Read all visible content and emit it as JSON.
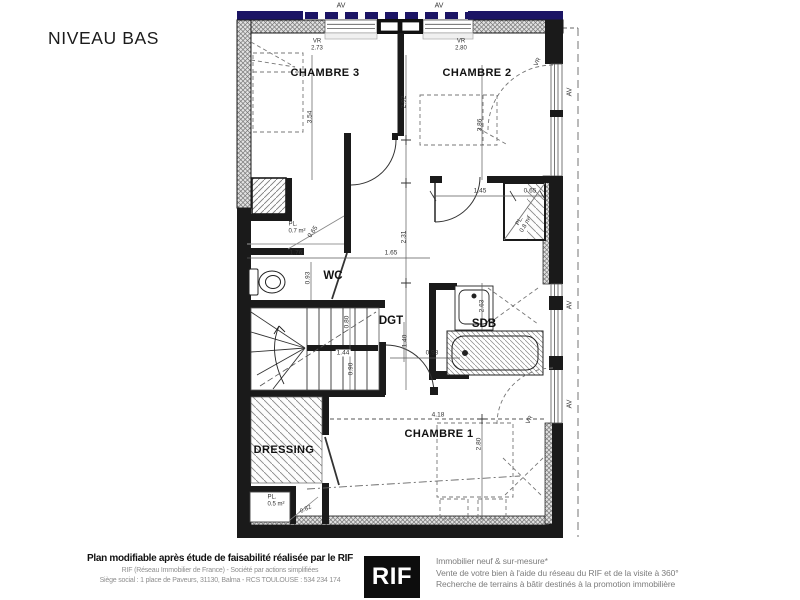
{
  "title": "NIVEAU BAS",
  "colors": {
    "wall": "#1a1a1a",
    "awning_navy": "#1b1464",
    "hatch_gray": "#8a8a8a"
  },
  "plan": {
    "rooms": {
      "chambre3": "CHAMBRE 3",
      "chambre2": "CHAMBRE 2",
      "chambre1": "CHAMBRE 1",
      "wc": "WC",
      "dgt": "DGT",
      "sdb": "SDB",
      "dressing": "DRESSING"
    },
    "labels": {
      "av": "AV",
      "vr": "VR",
      "vr_ch3": "2.73",
      "vr_ch2": "2.80",
      "pl": "PL.",
      "pl07": "0.7 m²",
      "pl08": "0.8 m²",
      "pl05": "0.5 m²",
      "level": "-0.82"
    },
    "dims": {
      "v354": "3.54",
      "v292": "2.92",
      "v386": "3.86",
      "h145": "1.45",
      "h065": "0.65",
      "v065": "0.65",
      "v231": "2.31",
      "h176": "1.76",
      "h165": "1.65",
      "v093": "0.93",
      "v263": "2.63",
      "v080": "0.80",
      "h144": "1.44",
      "v090": "0.90",
      "v140": "1.40",
      "h093": "0.93",
      "h418": "4.18",
      "v280": "2.80"
    }
  },
  "footer": {
    "disclaimer": "Plan modifiable après étude de faisabilité réalisée par le RIF",
    "company_line1": "RIF (Réseau Immobilier de France) - Société par actions simplifiées",
    "company_line2": "Siège social : 1 place de Paveurs, 31130, Balma - RCS TOULOUSE : 534 234 174",
    "logo_text": "RIF",
    "services_line1": "Immobilier neuf & sur-mesure*",
    "services_line2": "Vente de votre bien à l'aide du réseau du RIF et de la visite à 360°",
    "services_line3": "Recherche de terrains à bâtir destinés à la promotion immobilière"
  }
}
